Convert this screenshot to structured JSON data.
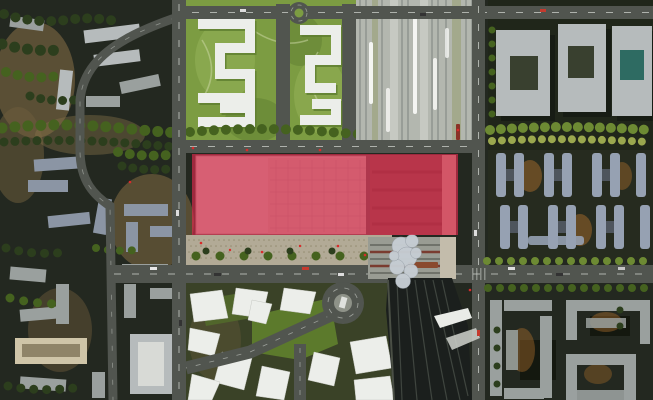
{
  "map": {
    "type": "aerial-masterplan-render",
    "title": "urban masterplan aerial view with highlighted station development site",
    "highlight": {
      "label": "highlighted-development-site",
      "color": "#e02a4e",
      "opacity": "0.65",
      "x": "192",
      "y": "154",
      "w": "266",
      "h": "81"
    },
    "regions": [
      {
        "name": "old-town-district",
        "side": "west"
      },
      {
        "name": "central-park-superblocks",
        "side": "north-center"
      },
      {
        "name": "railway-corridor",
        "side": "north-east"
      },
      {
        "name": "campus-blocks",
        "side": "east"
      },
      {
        "name": "residential-bar-buildings",
        "side": "east"
      },
      {
        "name": "station-complex",
        "side": "center"
      },
      {
        "name": "esplanade-plaza",
        "side": "center"
      },
      {
        "name": "planned-white-buildings",
        "side": "south-center"
      },
      {
        "name": "highway-roundabout",
        "side": "south-center"
      },
      {
        "name": "rail-track-fan",
        "side": "south-east"
      },
      {
        "name": "southeast-city-blocks",
        "side": "south-east"
      }
    ]
  },
  "colors": {
    "ground": "#232820",
    "terrain": "#6e5c3c",
    "treeDark": "#2c3e1d",
    "treeMid": "#45621f",
    "treeLight": "#6d8a33",
    "treeOlive": "#9aa74e",
    "road": "#51554f",
    "roadLight": "#8e9288",
    "laneMark": "#cdd1cb",
    "park": "#7c9c42",
    "parkLight": "#93b157",
    "parkShade": "#5e7d30",
    "pathLight": "#c9d6a0",
    "railway": "#b3b7af",
    "railStripe": "#989d97",
    "railPlatform": "#c6c9c2",
    "railGreen": "#a3a98c",
    "train": "#f4f5f2",
    "buildingLight": "#b6bbbc",
    "buildingMid": "#9aa09e",
    "buildingBlue": "#96a1b2",
    "buildingBlueDark": "#5f6878",
    "buildingSlate": "#8b95a4",
    "buildingTan": "#cfc5a8",
    "white": "#eceeea",
    "courtyard": "#39402f",
    "esplanade": "#b2aa96",
    "esplanadeDot": "#938c70",
    "slab": "#c7c3b8",
    "slabMid": "#bcb8aa",
    "slabLine": "#a19d90",
    "stationRoof": "#999c93",
    "stationDark": "#6e4a42",
    "redStripe": "#7a3c30",
    "fanDark": "#1b1f1d",
    "fanTrack": "#3f453f",
    "canopy": "#c6cdd3",
    "lawn": "#5c7a2c",
    "lawnDark": "#52692b",
    "orangeGlow": "#b5742c",
    "teal": "#2e6b62",
    "accentRed": "#d92b2b",
    "highlight": "#e02a4e"
  }
}
